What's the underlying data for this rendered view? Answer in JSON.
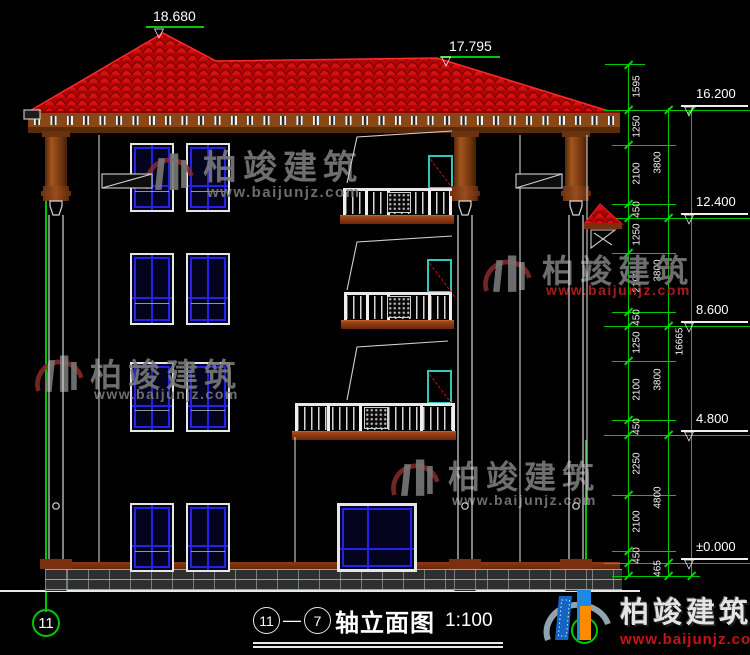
{
  "top_markers": {
    "roof_left": "18.680",
    "roof_right": "17.795"
  },
  "levels": [
    {
      "value": "16.200"
    },
    {
      "value": "12.400"
    },
    {
      "value": "8.600"
    },
    {
      "value": "4.800"
    },
    {
      "value": "±0.000"
    }
  ],
  "dim_chains": {
    "inner": [
      "1595",
      "1250",
      "2100",
      "450",
      "1250",
      "2100",
      "450",
      "1250",
      "2100",
      "450",
      "2250",
      "2100",
      "450"
    ],
    "floors": [
      "3800",
      "3800",
      "3800",
      "4800",
      "465"
    ],
    "total": [
      "16665"
    ]
  },
  "axis_bubbles": {
    "left": "11",
    "right": "7"
  },
  "title_block": {
    "axis_left": "11",
    "separator": "—",
    "axis_right": "7",
    "name": "轴立面图",
    "scale": "1:100"
  },
  "watermarks": [
    {
      "brand": "柏竣建筑",
      "url": "www.baijunjz.com"
    },
    {
      "brand": "柏竣建筑",
      "url": "www.baijunjz.com"
    },
    {
      "brand": "柏竣建筑",
      "url": "www.baijunjz.com"
    },
    {
      "brand": "柏竣建筑",
      "url": "www.baijunjz.com"
    }
  ],
  "footer": {
    "brand": "柏竣建筑",
    "url": "www.baijunjz.com"
  },
  "colors": {
    "axis_green": "#00c800",
    "roof_red": "#b40404",
    "window_blue": "#2222e8",
    "door_teal": "#30c8b8",
    "swing_red": "#cf0038",
    "railing_white": "#e8e8e8",
    "watermark_gray": "#7a7a7a",
    "watermark_red": "#b82020"
  }
}
